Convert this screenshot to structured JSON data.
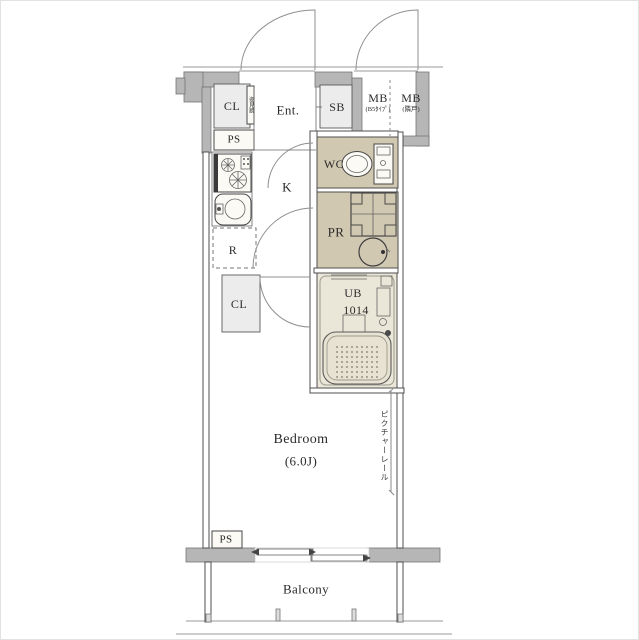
{
  "floorplan": {
    "entry": {
      "cl": "CL",
      "mirror": "姿見鏡",
      "ent": "Ent.",
      "sb": "SB",
      "ps": "PS"
    },
    "meter_boxes": {
      "left": {
        "label": "MB",
        "sub": "(B5ﾀｲﾌﾟ)"
      },
      "right": {
        "label": "MB",
        "sub": "(隣戸)"
      }
    },
    "kitchen": {
      "k": "K",
      "r": "R",
      "cl": "CL"
    },
    "wet_area": {
      "wc": "WC",
      "pr": "PR",
      "ub": {
        "label": "UB",
        "size": "1014"
      }
    },
    "bedroom": {
      "name": "Bedroom",
      "size": "(6.0J)",
      "picture_rail": "ピクチャーレール"
    },
    "bottom": {
      "ps": "PS",
      "balcony": "Balcony"
    },
    "colors": {
      "wall": "#b6b6b6",
      "room_gray": "#ececec",
      "beige": "#d1c8b1",
      "ub_floor": "#ebe7d8",
      "line": "#4f4f4f"
    }
  }
}
